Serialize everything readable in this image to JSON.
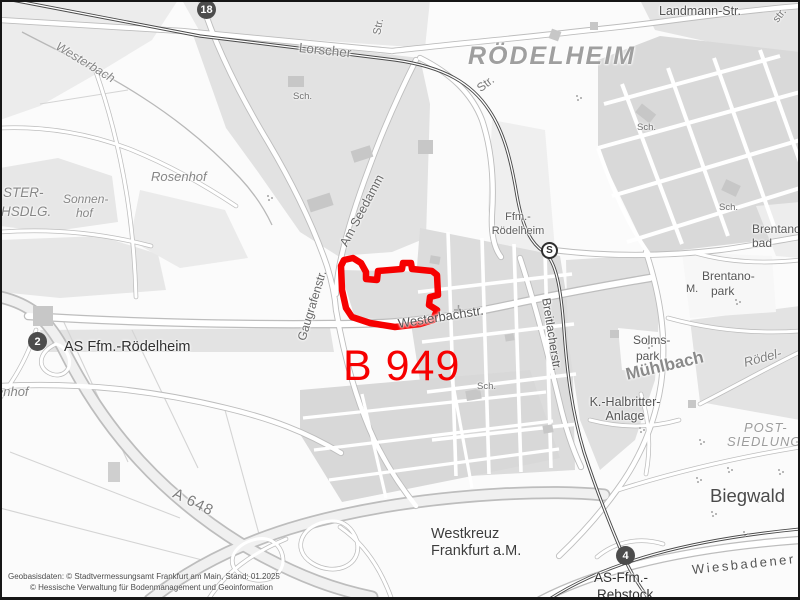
{
  "plan": {
    "number": "B 949"
  },
  "labels": {
    "district_main": "RÖDELHEIM",
    "landmann": "Landmann-Str.",
    "lorscher": "Lorscher",
    "str_curve": "Str.",
    "str_vertical": "Str.",
    "str_corner": "str.",
    "westerbach": "Westerbach",
    "rosenhof": "Rosenhof",
    "ster": "STER-",
    "hsdlg": "HSDLG.",
    "sonnen1": "Sonnen-",
    "sonnen2": "hof",
    "enhof": "enhof",
    "ffm1": "Ffm.-",
    "ffm2": "Rödelheim",
    "am_seedamm": "Am Seedamm",
    "gaugrafenstr": "Gaugrafenstr.",
    "westerbachstr": "Westerbachstr.",
    "breitlacherstr": "Breitlacherstr.",
    "sch": "Sch.",
    "brentano_bad1": "Brentano-",
    "brentano_bad2": "bad",
    "brentano_park1": "Brentano-",
    "brentano_park2": "park",
    "m_abbrev": "M.",
    "solms1": "Solms-",
    "solms2": "park",
    "muehlbach": "Mühlbach",
    "roedel": "Rödel-",
    "halbritter1": "K.-Halbritter-",
    "halbritter2": "Anlage",
    "post1": "POST-",
    "post2": "SIEDLUNG",
    "biegwald": "Biegwald",
    "wiesbadener": "Wiesbadener",
    "as_rebstock1": "AS-Ffm.-",
    "as_rebstock2": "Rebstock",
    "westkreuz1": "Westkreuz",
    "westkreuz2": "Frankfurt a.M.",
    "a648": "A 648",
    "as_roedelheim": "AS Ffm.-Rödelheim"
  },
  "markers": {
    "route18": "18",
    "exit2": "2",
    "exit4": "4",
    "sbahn": "S"
  },
  "attribution": {
    "line1": "Geobasisdaten: © Stadtvermessungsamt Frankfurt am Main, Stand: 01.2025",
    "line2": "© Hessische Verwaltung für Bodenmanagement und Geoinformation"
  },
  "colors": {
    "plan_outline": "#f60000",
    "badge": "#4c4c4c",
    "block_gray": "#dcdcdc"
  }
}
